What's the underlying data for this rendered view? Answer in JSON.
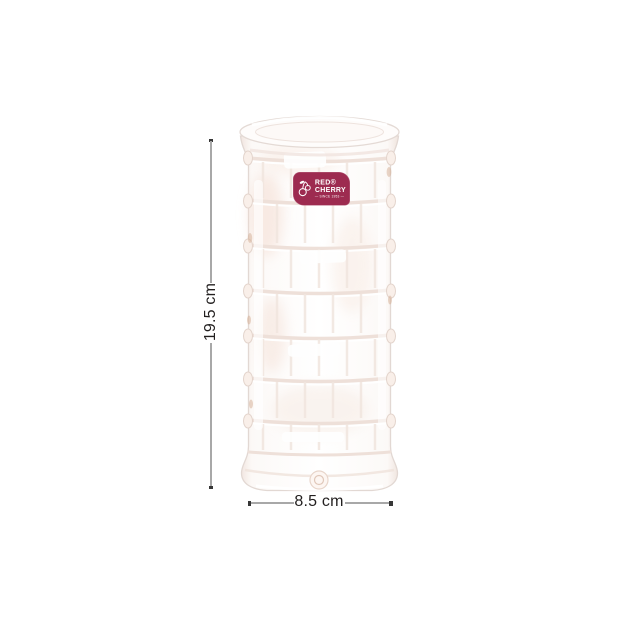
{
  "colors": {
    "background": "#ffffff",
    "label_bg": "#9d2b50",
    "label_text": "#ffffff",
    "dim_line": "#a8a8a8",
    "dim_cap": "#373737",
    "dim_text": "#221f1f"
  },
  "product": {
    "label": {
      "icon": "cherry-icon",
      "line1": "RED®",
      "line2": "CHERRY",
      "tagline": "— SINCE 1953 —"
    }
  },
  "dimensions": {
    "height_label": "19.5 cm",
    "width_label": "8.5 cm"
  }
}
